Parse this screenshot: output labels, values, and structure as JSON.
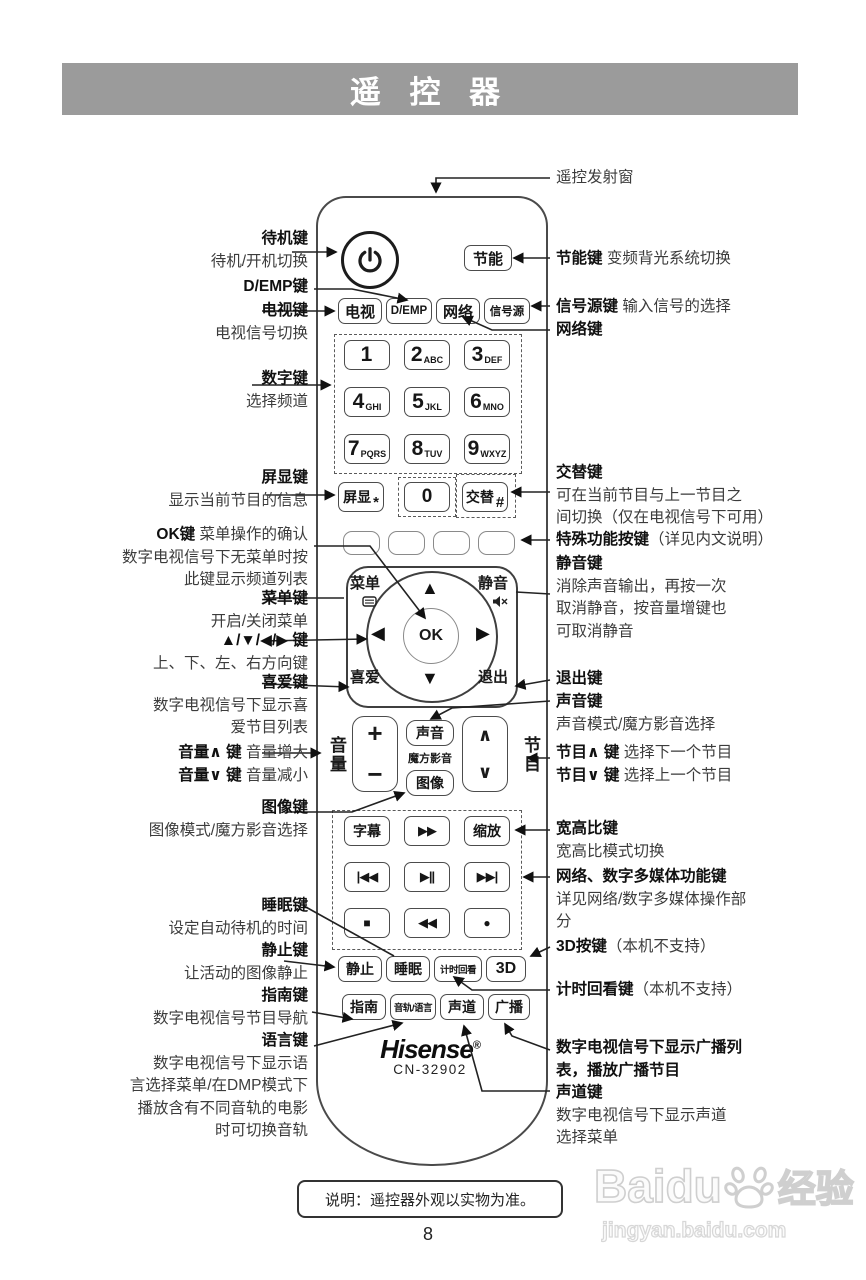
{
  "header": {
    "title": "遥 控 器"
  },
  "remote": {
    "brand": "Hisense",
    "reg_mark": "®",
    "model": "CN-32902",
    "keys": {
      "eco": "节能",
      "tv": "电视",
      "demp": "D/EMP",
      "network": "网络",
      "source": "信号源",
      "screen_display": "屏显",
      "screen_display_sub": "*",
      "zero": "0",
      "alternate": "交替",
      "alternate_sub": "#",
      "menu": "菜单",
      "mute": "静音",
      "favorite": "喜爱",
      "exit": "退出",
      "ok": "OK",
      "up": "▲",
      "down": "▼",
      "left": "◀",
      "right": "▶",
      "volume_label": "音量",
      "program_label": "节目",
      "vol_plus": "+",
      "vol_minus": "−",
      "prog_up": "∧",
      "prog_down": "∨",
      "sound": "声音",
      "cube_av": "魔方影音",
      "picture": "图像",
      "subtitle": "字幕",
      "fast_forward": "▶▶",
      "zoom": "缩放",
      "prev": "|◀◀",
      "play_pause": "▶||",
      "next": "▶▶|",
      "stop": "■",
      "rewind": "◀◀",
      "record": "●",
      "freeze": "静止",
      "sleep": "睡眠",
      "timeshift": "计时回看",
      "threed": "3D",
      "guide": "指南",
      "audio_language": "音轨/语言",
      "channel_sound": "声道",
      "broadcast": "广播"
    },
    "digits": [
      {
        "n": "1",
        "s": ""
      },
      {
        "n": "2",
        "s": "ABC"
      },
      {
        "n": "3",
        "s": "DEF"
      },
      {
        "n": "4",
        "s": "GHI"
      },
      {
        "n": "5",
        "s": "JKL"
      },
      {
        "n": "6",
        "s": "MNO"
      },
      {
        "n": "7",
        "s": "PQRS"
      },
      {
        "n": "8",
        "s": "TUV"
      },
      {
        "n": "9",
        "s": "WXYZ"
      }
    ]
  },
  "callouts_left": [
    {
      "lines": [
        {
          "b": "待机键"
        },
        {
          "t": "待机/开机切换"
        }
      ]
    },
    {
      "lines": [
        {
          "b": "D/EMP键"
        }
      ]
    },
    {
      "lines": [
        {
          "b": "电视键"
        },
        {
          "t": "电视信号切换"
        }
      ]
    },
    {
      "lines": [
        {
          "b": "数字键"
        },
        {
          "t": "选择频道"
        }
      ]
    },
    {
      "lines": [
        {
          "b": "屏显键"
        },
        {
          "t": "显示当前节目的信息"
        }
      ]
    },
    {
      "lines": [
        {
          "b": "OK键",
          "t": " 菜单操作的确认"
        },
        {
          "t": "数字电视信号下无菜单时按"
        },
        {
          "t": "此键显示频道列表"
        }
      ]
    },
    {
      "lines": [
        {
          "b": "菜单键"
        },
        {
          "t": "开启/关闭菜单"
        }
      ]
    },
    {
      "lines": [
        {
          "b": "▲/▼/◀/▶ 键"
        },
        {
          "t": "上、下、左、右方向键"
        }
      ]
    },
    {
      "lines": [
        {
          "b": "喜爱键"
        },
        {
          "t": "数字电视信号下显示喜"
        },
        {
          "t": "爱节目列表"
        }
      ]
    },
    {
      "lines": [
        {
          "b": "音量∧ 键",
          "t": " 音量增大"
        },
        {
          "b": "音量∨ 键",
          "t": " 音量减小"
        }
      ]
    },
    {
      "lines": [
        {
          "b": "图像键"
        },
        {
          "t": "图像模式/魔方影音选择"
        }
      ]
    },
    {
      "lines": [
        {
          "b": "睡眠键"
        },
        {
          "t": "设定自动待机的时间"
        }
      ]
    },
    {
      "lines": [
        {
          "b": "静止键"
        },
        {
          "t": "让活动的图像静止"
        }
      ]
    },
    {
      "lines": [
        {
          "b": "指南键"
        },
        {
          "t": "数字电视信号节目导航"
        }
      ]
    },
    {
      "lines": [
        {
          "b": "语言键"
        },
        {
          "t": "数字电视信号下显示语"
        },
        {
          "t": "言选择菜单/在DMP模式下"
        },
        {
          "t": "播放含有不同音轨的电影"
        },
        {
          "t": "时可切换音轨"
        }
      ]
    }
  ],
  "callouts_right": [
    {
      "lines": [
        {
          "t": "遥控发射窗"
        }
      ]
    },
    {
      "lines": [
        {
          "b": "节能键",
          "t": " 变频背光系统切换"
        }
      ]
    },
    {
      "lines": [
        {
          "b": "信号源键",
          "t": " 输入信号的选择"
        }
      ]
    },
    {
      "lines": [
        {
          "b": "网络键"
        }
      ]
    },
    {
      "lines": [
        {
          "b": "交替键"
        },
        {
          "t": "可在当前节目与上一节目之"
        },
        {
          "t": "间切换（仅在电视信号下可用）"
        }
      ]
    },
    {
      "lines": [
        {
          "b": "特殊功能按键",
          "t": "（详见内文说明）"
        }
      ]
    },
    {
      "lines": [
        {
          "b": "静音键"
        },
        {
          "t": "消除声音输出，再按一次"
        },
        {
          "t": "取消静音，按音量增键也"
        },
        {
          "t": "可取消静音"
        }
      ]
    },
    {
      "lines": [
        {
          "b": "退出键"
        }
      ]
    },
    {
      "lines": [
        {
          "b": "声音键"
        },
        {
          "t": "声音模式/魔方影音选择"
        }
      ]
    },
    {
      "lines": [
        {
          "b": "节目∧ 键",
          "t": " 选择下一个节目"
        },
        {
          "b": "节目∨ 键",
          "t": " 选择上一个节目"
        }
      ]
    },
    {
      "lines": [
        {
          "b": "宽高比键"
        },
        {
          "t": "宽高比模式切换"
        }
      ]
    },
    {
      "lines": [
        {
          "b": "网络、数字多媒体功能键"
        },
        {
          "t": "详见网络/数字多媒体操作部"
        },
        {
          "t": "分"
        }
      ]
    },
    {
      "lines": [
        {
          "b": "3D按键",
          "t": "（本机不支持）"
        }
      ]
    },
    {
      "lines": [
        {
          "b": "计时回看键",
          "t": "（本机不支持）"
        }
      ]
    },
    {
      "lines": [
        {
          "b": "数字电视信号下显示广播列"
        },
        {
          "b": "表，播放广播节目"
        }
      ]
    },
    {
      "lines": [
        {
          "b": "声道键"
        },
        {
          "t": "数字电视信号下显示声道"
        },
        {
          "t": "选择菜单"
        }
      ]
    }
  ],
  "footer": {
    "note": "说明：遥控器外观以实物为准。",
    "page_number": "8",
    "watermark_brand": "Baidu",
    "watermark_suffix": "经验",
    "watermark_url": "jingyan.baidu.com"
  }
}
